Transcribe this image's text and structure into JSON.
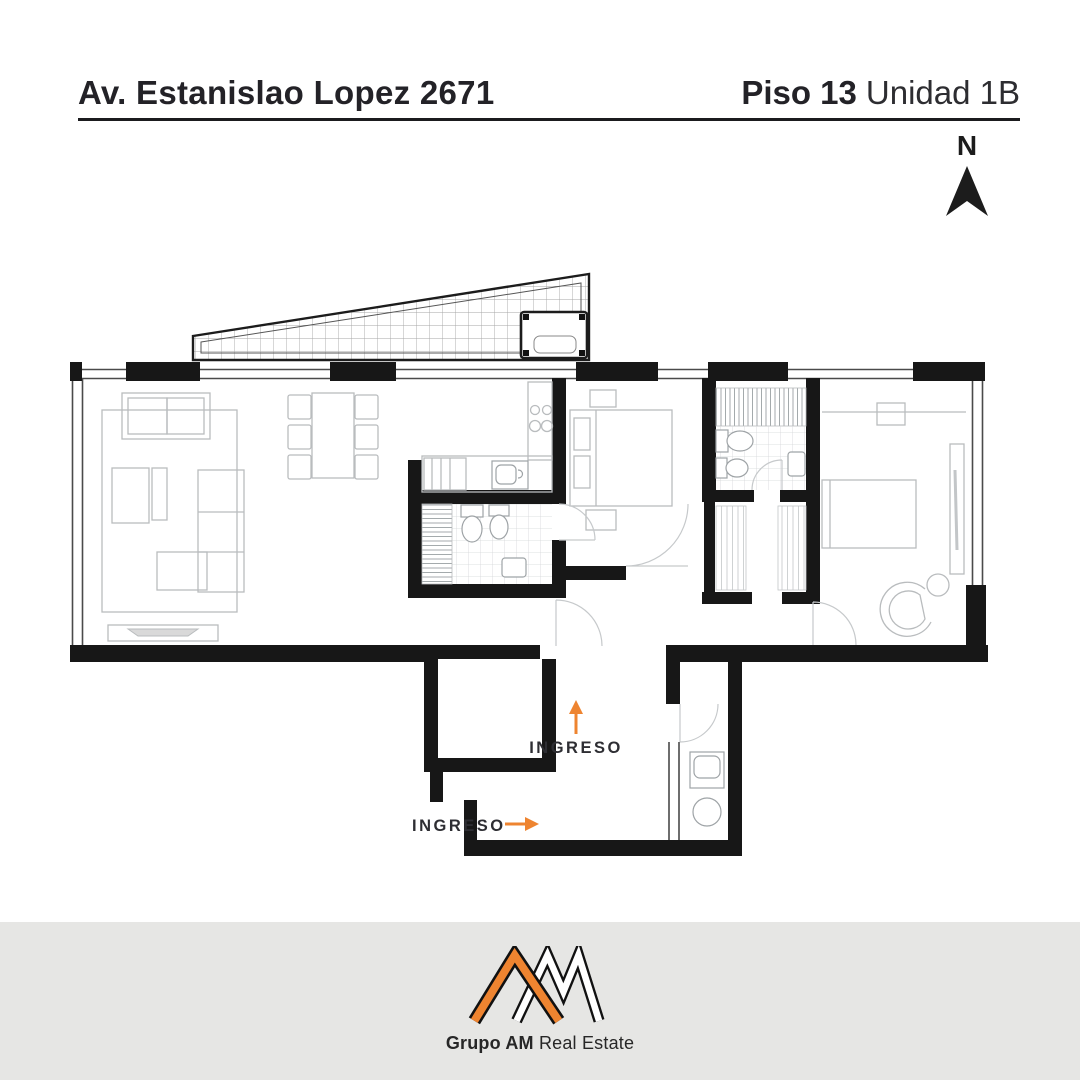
{
  "header": {
    "address": "Av. Estanislao Lopez 2671",
    "floor": "Piso 13",
    "unit": "Unidad 1B"
  },
  "compass": {
    "label": "N",
    "icon": "north-arrow-icon"
  },
  "plan": {
    "type": "apartment-floor-plan",
    "entrances": [
      {
        "label": "INGRESO",
        "arrow": "up-arrow-icon"
      },
      {
        "label": "INGRESO",
        "arrow": "right-arrow-icon"
      }
    ],
    "features": [
      "terrace-with-grid",
      "living-dining",
      "kitchen",
      "bathroom",
      "bedroom-1",
      "bathroom-2",
      "dressing",
      "bedroom-2",
      "entry-hall",
      "laundry"
    ]
  },
  "footer": {
    "brand_bold": "Grupo AM",
    "brand_regular": "Real Estate",
    "logo": "am-monogram"
  },
  "colors": {
    "accent_orange": "#EE8430",
    "wall_black": "#171717",
    "furniture_gray": "#B9BCBE",
    "footer_bg": "#E6E6E4",
    "text_dark": "#232227"
  }
}
